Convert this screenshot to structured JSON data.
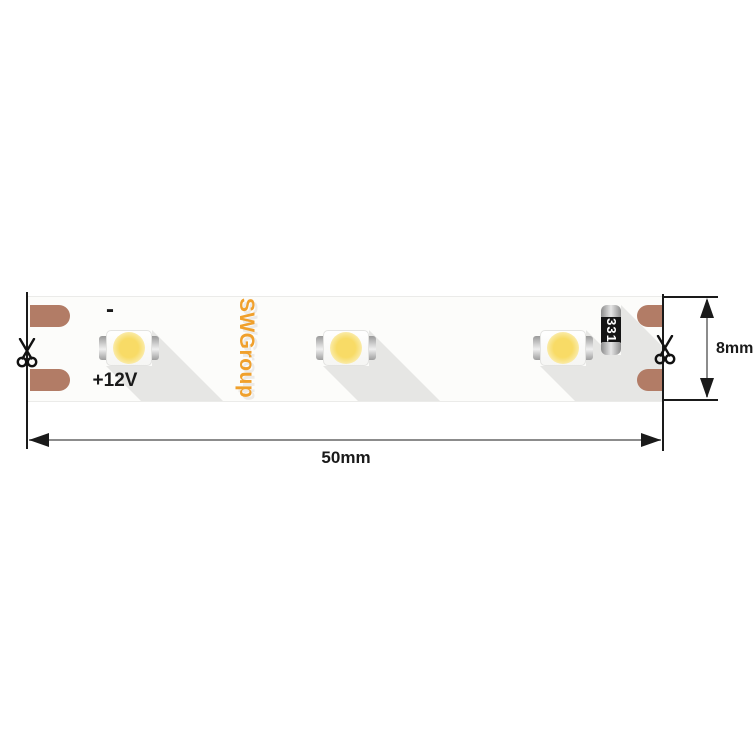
{
  "diagram": {
    "brand_label": "SWGroup",
    "polarity_minus": "-",
    "voltage_label": "+12V",
    "resistor_code": "331",
    "led_count": 3,
    "width_dimension": "50mm",
    "height_dimension": "8mm"
  },
  "icons": {
    "left_cut_mark": "scissors-icon",
    "right_cut_mark": "scissors-icon"
  },
  "colors": {
    "copper_pad": "#b27c66",
    "brand_orange": "#f0a02c",
    "led_yellow": "#f8db66",
    "strip_shadow": "#e6e6e4",
    "resistor_body": "#141414",
    "dimension_line": "#8c8c8c",
    "outline_black": "#1a1a1a"
  }
}
